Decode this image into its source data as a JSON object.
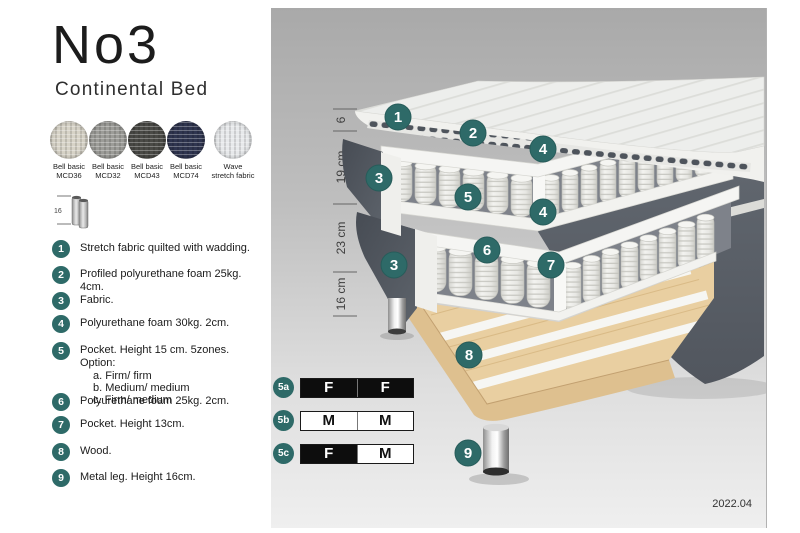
{
  "header": {
    "title": "No3",
    "subtitle": "Continental Bed"
  },
  "swatches": [
    {
      "line1": "Bell basic",
      "line2": "MCD36",
      "color": "#d7d3c7"
    },
    {
      "line1": "Bell basic",
      "line2": "MCD32",
      "color": "#9c9c98"
    },
    {
      "line1": "Bell basic",
      "line2": "MCD43",
      "color": "#4a4a46"
    },
    {
      "line1": "Bell basic",
      "line2": "MCD74",
      "color": "#2f3550"
    },
    {
      "line1": "Wave",
      "line2": "stretch fabric",
      "color": "#e7e9eb"
    }
  ],
  "leg_icon": {
    "height_label": "16"
  },
  "spec_items": [
    {
      "num": "1",
      "text": "Stretch fabric quilted with wadding."
    },
    {
      "num": "2",
      "text": "Profiled polyurethane foam 25kg. 4cm."
    },
    {
      "num": "3",
      "text": "Fabric."
    },
    {
      "num": "4",
      "text": "Polyurethane foam 30kg. 2cm."
    },
    {
      "num": "5",
      "text": "Pocket. Height 15 cm. 5zones. Option:",
      "options": [
        "a. Firm/ firm",
        "b. Medium/ medium",
        "c. Firm/ medium"
      ]
    },
    {
      "num": "6",
      "text": "Polyurethane foam 25kg. 2cm."
    },
    {
      "num": "7",
      "text": "Pocket. Height 13cm."
    },
    {
      "num": "8",
      "text": "Wood."
    },
    {
      "num": "9",
      "text": "Metal leg. Height 16cm."
    }
  ],
  "diagram": {
    "dimension_labels": [
      "6",
      "19 cm",
      "23 cm",
      "16 cm"
    ],
    "callout_labels": {
      "c1": "1",
      "c2": "2",
      "c3": "3",
      "c4": "4",
      "c5": "5",
      "c6": "6",
      "c7": "7",
      "c8": "8",
      "c9": "9"
    },
    "accent_color": "#2E6A68"
  },
  "firmness_table": {
    "rows": [
      {
        "label": "5a",
        "cells": [
          {
            "value": "F",
            "variant": "dark"
          },
          {
            "value": "F",
            "variant": "dark"
          }
        ]
      },
      {
        "label": "5b",
        "cells": [
          {
            "value": "M",
            "variant": "light"
          },
          {
            "value": "M",
            "variant": "light"
          }
        ]
      },
      {
        "label": "5c",
        "cells": [
          {
            "value": "F",
            "variant": "dark"
          },
          {
            "value": "M",
            "variant": "light"
          }
        ]
      }
    ]
  },
  "footer": {
    "version": "2022.04"
  }
}
